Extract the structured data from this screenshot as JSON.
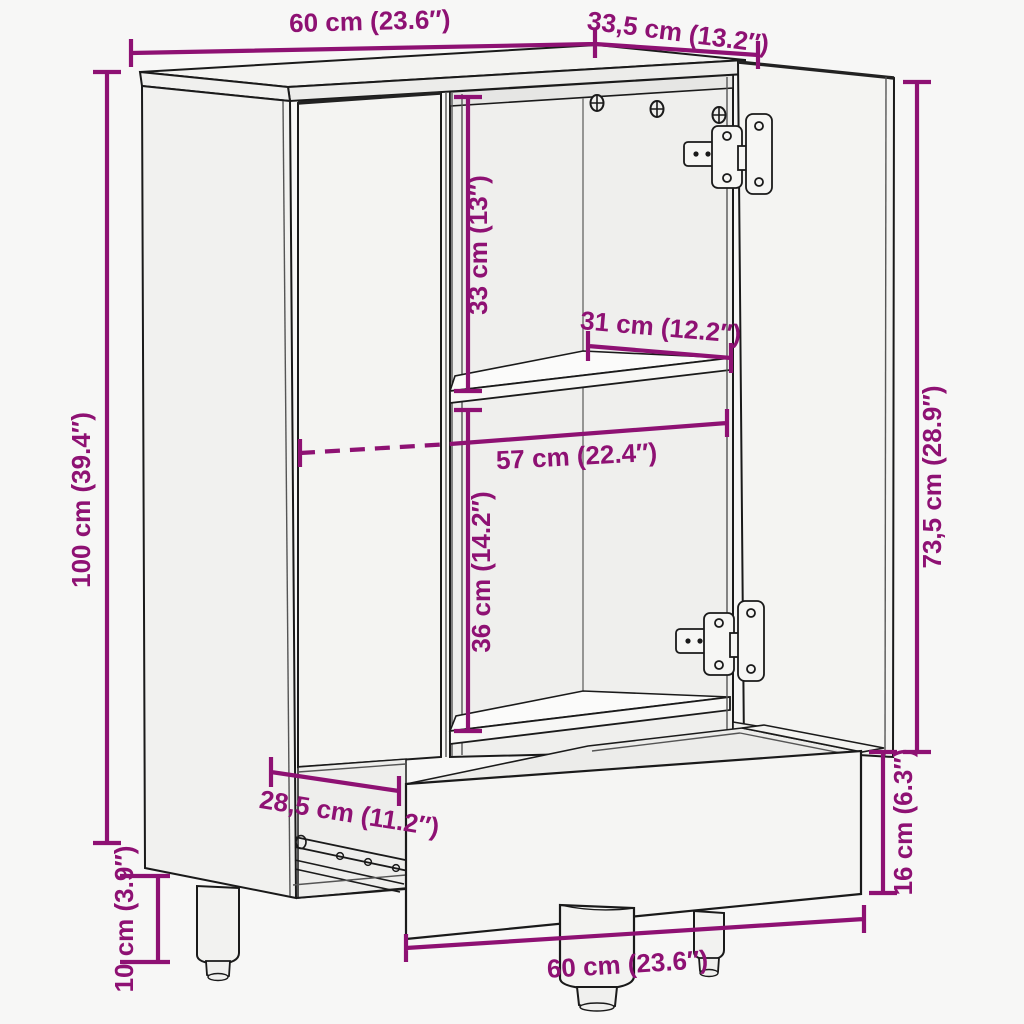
{
  "diagram": {
    "subject": "highboard-cabinet-dimension-drawing",
    "background_color": "#f7f7f6",
    "outline_color": "#1a1a1a",
    "accent_color": "#8E1173"
  },
  "icons": {
    "screw": "phillips-screw-icon",
    "hinge": "cup-hinge-icon"
  },
  "dimensions": {
    "top_width": {
      "label": "60 cm (23.6″)"
    },
    "top_depth": {
      "label": "33,5 cm (13.2″)"
    },
    "overall_height": {
      "label": "100 cm (39.4″)"
    },
    "upper_compartment": {
      "label": "33 cm (13″)"
    },
    "shelf_width": {
      "label": "31 cm (12.2″)"
    },
    "interior_width": {
      "label": "57 cm (22.4″)"
    },
    "lower_compartment": {
      "label": "36 cm (14.2″)"
    },
    "door_height": {
      "label": "73,5 cm (28.9″)"
    },
    "drawer_height": {
      "label": "16 cm (6.3″)"
    },
    "drawer_depth": {
      "label": "28,5 cm (11.2″)"
    },
    "leg_height": {
      "label": "10 cm (3.9″)"
    },
    "bottom_width": {
      "label": "60 cm (23.6″)"
    }
  }
}
